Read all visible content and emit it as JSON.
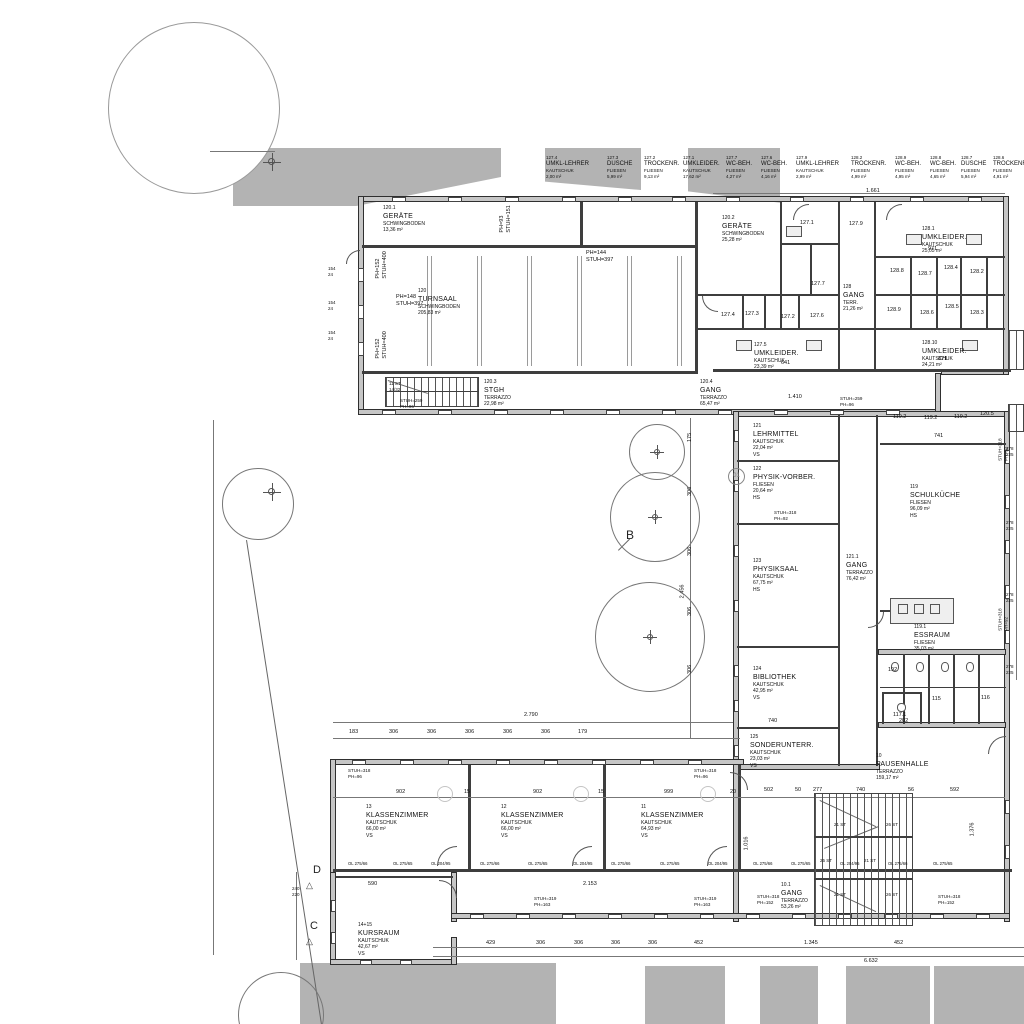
{
  "top_labels": [
    {
      "num": "127.4",
      "name": "UMKL-LEHRER",
      "floor": "KAUTSCHUK",
      "area": "2,00 m²"
    },
    {
      "num": "127.3",
      "name": "DUSCHE",
      "floor": "FLIESEN",
      "area": "5,99 m²"
    },
    {
      "num": "127.2",
      "name": "TROCKENR.",
      "floor": "FLIESEN",
      "area": "9,13 m²"
    },
    {
      "num": "127.1",
      "name": "UMKLEIDER.",
      "floor": "KAUTSCHUK",
      "area": "17,62 m²"
    },
    {
      "num": "127.7",
      "name": "WC-BEH.",
      "floor": "FLIESEN",
      "area": "4,27 m²"
    },
    {
      "num": "127.6",
      "name": "WC-BEH.",
      "floor": "FLIESEN",
      "area": "4,16 m²"
    },
    {
      "num": "127.9",
      "name": "UMKL-LEHRER",
      "floor": "KAUTSCHUK",
      "area": "2,99 m²"
    },
    {
      "num": "128.2",
      "name": "TROCKENR.",
      "floor": "FLIESEN",
      "area": "4,99 m²"
    },
    {
      "num": "128.9",
      "name": "WC-BEH.",
      "floor": "FLIESEN",
      "area": "4,95 m²"
    },
    {
      "num": "128.8",
      "name": "WC-BEH.",
      "floor": "FLIESEN",
      "area": "4,65 m²"
    },
    {
      "num": "128.7",
      "name": "DUSCHE",
      "floor": "FLIESEN",
      "area": "5,94 m²"
    },
    {
      "num": "128.6",
      "name": "TROCKENR.",
      "floor": "FLIESEN",
      "area": "4,91 m²"
    }
  ],
  "rooms": [
    {
      "id": "geraete1",
      "num": "120.1",
      "name": "GERÄTE",
      "floor": "SCHWINGBODEN",
      "area": "13,36 m²"
    },
    {
      "id": "geraete2",
      "num": "120.2",
      "name": "GERÄTE",
      "floor": "SCHWINGBODEN",
      "area": "25,28 m²"
    },
    {
      "id": "turnsaal",
      "num": "120",
      "name": "TURNSAAL",
      "floor": "SCHWINGBODEN",
      "area": "205,83 m²"
    },
    {
      "id": "stgh",
      "num": "120.3",
      "name": "STGH",
      "floor": "TERRAZZO",
      "area": "22,98 m²"
    },
    {
      "id": "gang1204",
      "num": "120.4",
      "name": "GANG",
      "floor": "TERRAZZO",
      "area": "65,47 m²"
    },
    {
      "id": "umkl1281",
      "num": "128.1",
      "name": "UMKLEIDER.",
      "floor": "KAUTSCHUK",
      "area": "25,05 m²"
    },
    {
      "id": "gang128",
      "num": "128",
      "name": "GANG",
      "floor": "TERR.",
      "area": "21,26 m²"
    },
    {
      "id": "umkl1275",
      "num": "127.5",
      "name": "UMKLEIDER.",
      "floor": "KAUTSCHUK",
      "area": "23,39 m²"
    },
    {
      "id": "umkl12810",
      "num": "128.10",
      "name": "UMKLEIDER.",
      "floor": "KAUTSCHUK",
      "area": "24,21 m²"
    },
    {
      "id": "lehrmittel",
      "num": "121",
      "name": "LEHRMITTEL",
      "floor": "KAUTSCHUK",
      "area": "22,04 m²",
      "note": "VS"
    },
    {
      "id": "physikvorber",
      "num": "122",
      "name": "PHYSIK-VORBER.",
      "floor": "FLIESEN",
      "area": "20,64 m²",
      "note": "HS"
    },
    {
      "id": "physiksaal",
      "num": "123",
      "name": "PHYSIKSAAL",
      "floor": "KAUTSCHUK",
      "area": "67,75 m²",
      "note": "HS"
    },
    {
      "id": "bibliothek",
      "num": "124",
      "name": "BIBLIOTHEK",
      "floor": "KAUTSCHUK",
      "area": "42,95 m²",
      "note": "VS"
    },
    {
      "id": "sonderunterr",
      "num": "125",
      "name": "SONDERUNTERR.",
      "floor": "KAUTSCHUK",
      "area": "23,03 m²",
      "note": "VS"
    },
    {
      "id": "gang1211",
      "num": "121.1",
      "name": "GANG",
      "floor": "TERRAZZO",
      "area": "76,42 m²"
    },
    {
      "id": "schulkueche",
      "num": "119",
      "name": "SCHULKÜCHE",
      "floor": "FLIESEN",
      "area": "96,09 m²",
      "note": "HS"
    },
    {
      "id": "essraum",
      "num": "119.1",
      "name": "ESSRAUM",
      "floor": "FLIESEN",
      "area": "35,03 m²"
    },
    {
      "id": "pausenhalle",
      "num": "10",
      "name": "PAUSENHALLE",
      "floor": "TERRAZZO",
      "area": "159,17 m²"
    },
    {
      "id": "kz13",
      "num": "13",
      "name": "KLASSENZIMMER",
      "floor": "KAUTSCHUK",
      "area": "66,00 m²",
      "note": "VS"
    },
    {
      "id": "kz12",
      "num": "12",
      "name": "KLASSENZIMMER",
      "floor": "KAUTSCHUK",
      "area": "66,00 m²",
      "note": "VS"
    },
    {
      "id": "kz11",
      "num": "11",
      "name": "KLASSENZIMMER",
      "floor": "KAUTSCHUK",
      "area": "64,93 m²",
      "note": "VS"
    },
    {
      "id": "gang101",
      "num": "10.1",
      "name": "GANG",
      "floor": "TERRAZZO",
      "area": "53,26 m²"
    },
    {
      "id": "kursraum",
      "num": "14+15",
      "name": "KURSRAUM",
      "floor": "KAUTSCHUK",
      "area": "42,67 m²",
      "note": "VS"
    }
  ],
  "small_rooms": [
    "127.1",
    "127.9",
    "127.7",
    "127.6",
    "127.4",
    "127.3",
    "127.2",
    "128.8",
    "128.7",
    "128.4",
    "128.2",
    "128.9",
    "128.6",
    "128.5",
    "128.3",
    "119.2",
    "119.2",
    "119.2",
    "120.5",
    "115",
    "116",
    "117.1"
  ],
  "annotations": [
    {
      "id": "n1661",
      "t": "1.661"
    },
    {
      "id": "ph93",
      "t": "PH=93\nSTUH=151"
    },
    {
      "id": "ph152a",
      "t": "PH=152\nSTUH=400"
    },
    {
      "id": "ph152b",
      "t": "PH=152\nSTUH=400"
    },
    {
      "id": "ph144",
      "t": "PH=144\nSTUH=397"
    },
    {
      "id": "ph148",
      "t": "PH=148\nSTUH=397"
    },
    {
      "id": "st11",
      "t": "11 ST\n14/32"
    },
    {
      "id": "st259a",
      "t": "STUH=259\nPH=96"
    },
    {
      "id": "n1410",
      "t": "1.410"
    },
    {
      "id": "st259b",
      "t": "STUH=259\nPH=96"
    },
    {
      "id": "n2790",
      "t": "2.790"
    },
    {
      "id": "n2153",
      "t": "2.153"
    },
    {
      "id": "n590",
      "t": "590"
    },
    {
      "id": "n6632",
      "t": "6.632"
    },
    {
      "id": "st318a",
      "t": "STUH=318\nPH=96"
    },
    {
      "id": "st318b",
      "t": "STUH=318\nPH=96"
    },
    {
      "id": "st319a",
      "t": "STUH=319\nPH=163"
    },
    {
      "id": "st319b",
      "t": "STUH=319\nPH=163"
    },
    {
      "id": "st318c",
      "t": "STUH=318\nPH=152"
    },
    {
      "id": "st318d",
      "t": "STUH=318\nPH=152"
    },
    {
      "id": "st318e",
      "t": "STUH=318\nPH=92"
    },
    {
      "id": "st318f",
      "t": "STUH=318\nPH=92"
    },
    {
      "id": "st318g",
      "t": "STUH=318\nPH=92"
    },
    {
      "id": "n741",
      "t": "741"
    },
    {
      "id": "n192",
      "t": "192"
    },
    {
      "id": "n202",
      "t": "202"
    },
    {
      "id": "n971",
      "t": "971"
    },
    {
      "id": "n871",
      "t": "871"
    },
    {
      "id": "n641",
      "t": "641"
    },
    {
      "id": "n740a",
      "t": "740"
    },
    {
      "id": "n1016",
      "t": "1.016"
    },
    {
      "id": "n1376",
      "t": "1.376"
    },
    {
      "id": "n2456",
      "t": "2.456"
    },
    {
      "id": "n175",
      "t": "175"
    },
    {
      "id": "v306a",
      "t": "306"
    },
    {
      "id": "v306b",
      "t": "306"
    },
    {
      "id": "v306c",
      "t": "306"
    },
    {
      "id": "v306d",
      "t": "306"
    },
    {
      "id": "w278a",
      "t": "278\n225"
    },
    {
      "id": "w278b",
      "t": "278\n225"
    },
    {
      "id": "w278c",
      "t": "278\n225"
    },
    {
      "id": "w278d",
      "t": "278\n225"
    },
    {
      "id": "w154a",
      "t": "154\n24"
    },
    {
      "id": "w154b",
      "t": "154\n24"
    },
    {
      "id": "w154c",
      "t": "154\n24"
    },
    {
      "id": "n240220",
      "t": "240\n220"
    }
  ],
  "dims": {
    "bottom": [
      "429",
      "306",
      "306",
      "306",
      "306",
      "452",
      "1.345",
      "452"
    ],
    "wing": [
      "902",
      "15",
      "902",
      "15",
      "999",
      "20"
    ],
    "hall": [
      "502",
      "50",
      "277",
      "740",
      "56",
      "592"
    ],
    "upper": [
      "183",
      "306",
      "306",
      "306",
      "306",
      "306",
      "179"
    ]
  },
  "window_labels": [
    "OL 275/66",
    "OL 275/65",
    "OL 204/95"
  ],
  "stair_labels": [
    "21 ST",
    "26 ST",
    "25 ST",
    "21 ST",
    "21 ST",
    "26 ST"
  ],
  "markers": {
    "b": "B",
    "c": "C",
    "d": "D",
    "bubble": "01",
    "tri": "△"
  }
}
